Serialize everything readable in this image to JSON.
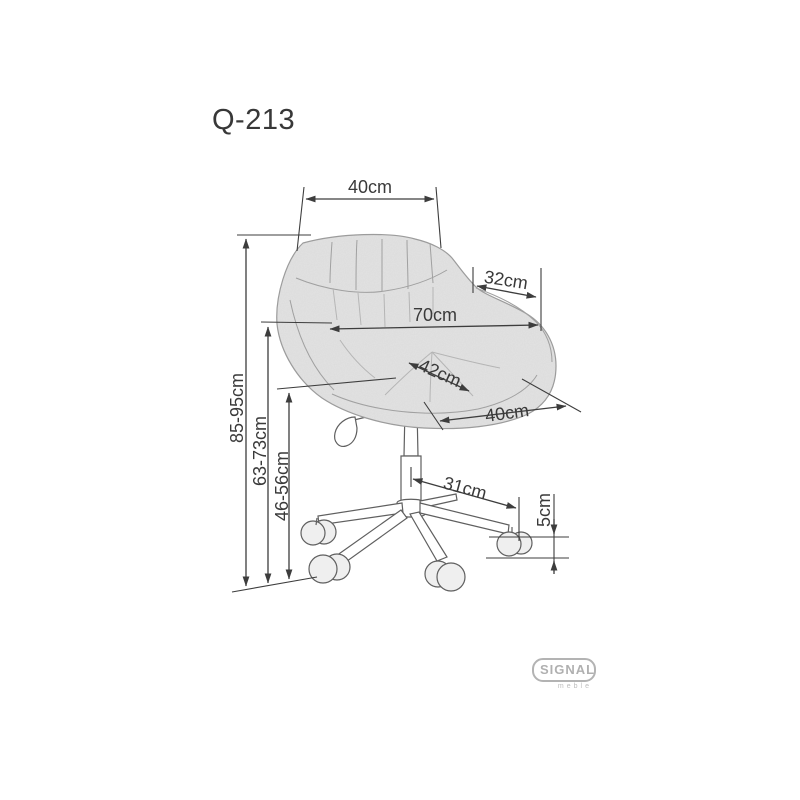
{
  "title": "Q-213",
  "brand": {
    "name": "SIGNAL",
    "tagline": "meble"
  },
  "diagram": {
    "type": "furniture-dimension-drawing",
    "subject": "office swivel tub chair with castors",
    "dims": {
      "back_width": "40cm",
      "total_height": "85-95cm",
      "back_height": "63-73cm",
      "seat_height": "46-56cm",
      "total_width": "70cm",
      "arm_depth": "32cm",
      "seat_width": "42cm",
      "seat_depth": "40cm",
      "base_radius": "31cm",
      "caster_height": "5cm"
    },
    "colors": {
      "line": "#3d3d3d",
      "text": "#3a3a3a",
      "chair_fill": "#e3e3e3",
      "chair_outline": "#9a9a9a",
      "logo": "#b3b3b3",
      "background": "#ffffff"
    }
  }
}
